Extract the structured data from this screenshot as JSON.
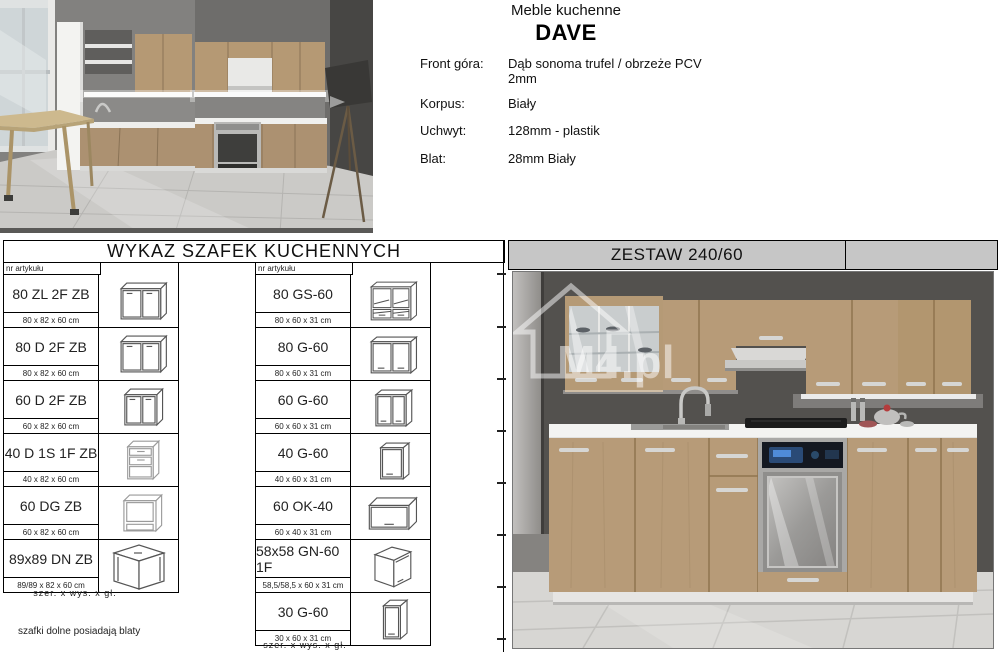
{
  "header": {
    "subtitle": "Meble kuchenne",
    "title": "DAVE",
    "specs": [
      {
        "label": "Front góra:",
        "value": "Dąb sonoma trufel / obrzeże PCV 2mm"
      },
      {
        "label": "Korpus:",
        "value": "Biały"
      },
      {
        "label": "Uchwyt:",
        "value": "128mm - plastik"
      },
      {
        "label": "Blat:",
        "value": "28mm Biały"
      }
    ]
  },
  "cabinet_table": {
    "title": "WYKAZ SZAFEK KUCHENNYCH",
    "column_header": "nr artykułu",
    "left": [
      {
        "code": "80 ZL 2F ZB",
        "dims": "80 x 82 x 60 cm",
        "icon": "base-2door-wide"
      },
      {
        "code": "80 D 2F ZB",
        "dims": "80 x 82 x 60 cm",
        "icon": "base-2door-wide"
      },
      {
        "code": "60 D 2F ZB",
        "dims": "60 x 82 x 60 cm",
        "icon": "base-2door"
      },
      {
        "code": "40 D 1S 1F ZB",
        "dims": "40 x 82 x 60 cm",
        "icon": "base-drawer-door"
      },
      {
        "code": "60 DG ZB",
        "dims": "60 x 82 x 60 cm",
        "icon": "base-oven-open"
      },
      {
        "code": "89x89 DN ZB",
        "dims": "89/89 x 82 x 60 cm",
        "icon": "base-corner"
      }
    ],
    "right": [
      {
        "code": "80 GS-60",
        "dims": "80 x 60 x 31 cm",
        "icon": "wall-glass-drawers"
      },
      {
        "code": "80 G-60",
        "dims": "80 x 60 x 31 cm",
        "icon": "wall-2door-wide"
      },
      {
        "code": "60 G-60",
        "dims": "60 x 60 x 31 cm",
        "icon": "wall-2door"
      },
      {
        "code": "40 G-60",
        "dims": "40 x 60 x 31 cm",
        "icon": "wall-1door"
      },
      {
        "code": "60 OK-40",
        "dims": "60 x 40 x 31 cm",
        "icon": "wall-flipup"
      },
      {
        "code": "58x58 GN-60 1F",
        "dims": "58,5/58,5 x 60 x 31 cm",
        "icon": "wall-corner"
      },
      {
        "code": "30 G-60",
        "dims": "30 x 60 x 31 cm",
        "icon": "wall-1door-narrow"
      }
    ],
    "legend": "szer.  x  wys.  x  gł.",
    "footnote": "szafki dolne posiadają blaty"
  },
  "set_panel": {
    "title": "ZESTAW 240/60",
    "watermark": "M4.pl"
  },
  "colors": {
    "panel_header_bg": "#c6c6c6",
    "wood": "#b79b78",
    "wall_dark": "#53514e",
    "floor_light": "#d7d6d3",
    "counter_white": "#f3f3f1"
  }
}
